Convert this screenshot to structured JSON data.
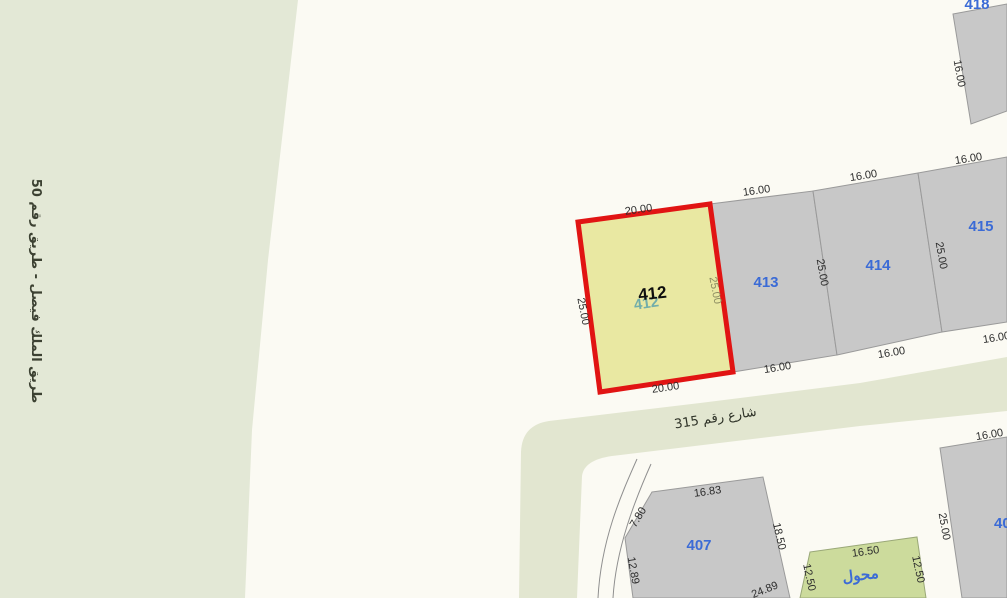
{
  "roads": {
    "king_faisal_label": "طريق الملك فيصل - طريق رقم 50",
    "street_315_label": "شارع رقم 315"
  },
  "selected_parcel": {
    "label": "412",
    "base_label": "412",
    "dim_top": "20.00",
    "dim_bottom": "20.00",
    "dim_left": "25.00",
    "dim_right": "25.00"
  },
  "parcels": {
    "p413": {
      "label": "413",
      "dim_top": "16.00",
      "dim_bottom": "16.00",
      "dim_side": "25.00"
    },
    "p414": {
      "label": "414",
      "dim_top": "16.00",
      "dim_bottom": "16.00",
      "dim_side": "25.00"
    },
    "p415": {
      "label": "415",
      "dim_top": "16.00",
      "dim_bottom": "16.00"
    },
    "p418": {
      "label": "418",
      "dim_side": "16.00"
    },
    "p407": {
      "label": "407",
      "dim_top": "16.83",
      "dim_corner": "7.80",
      "dim_left": "12.89",
      "dim_right": "18.50",
      "dim_bottom": "24.89"
    },
    "transformer": {
      "label": "محول",
      "dim_top": "16.50",
      "dim_left": "12.50",
      "dim_right": "12.50"
    },
    "p40": {
      "label": "40",
      "dim_top": "16.00",
      "dim_side": "25.00"
    }
  },
  "colors": {
    "background": "#fbfaf3",
    "park_green": "#e3e8d6",
    "street_green": "#e2e6d0",
    "parcel_fill": "#c8c8c8",
    "parcel_border": "#9a9a9a",
    "parcel_label_blue": "#3b6bd6",
    "highlight_fill": "#e9e8a2",
    "highlight_border": "#e11413",
    "transformer_fill": "#ccdb9c",
    "base_label_teal": "#55a0ac",
    "dimension_text": "#2d2d2d"
  }
}
